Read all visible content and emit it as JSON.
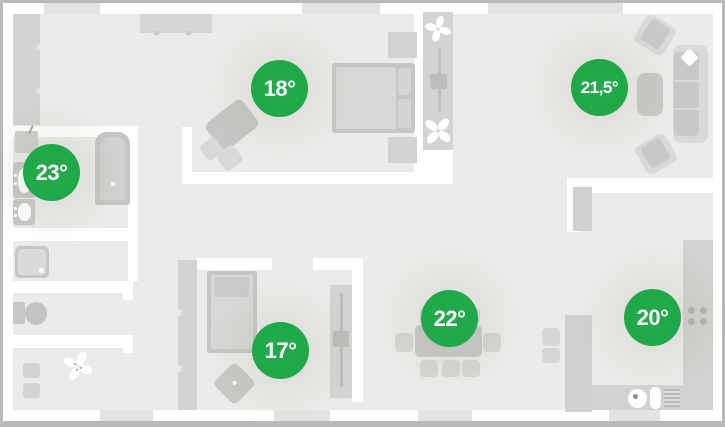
{
  "floorplan": {
    "rooms": [
      {
        "id": "bedroom",
        "temp": "18°"
      },
      {
        "id": "living-room",
        "temp": "21,5°"
      },
      {
        "id": "bathroom",
        "temp": "23°"
      },
      {
        "id": "kids-room",
        "temp": "17°"
      },
      {
        "id": "dining-area",
        "temp": "22°"
      },
      {
        "id": "kitchen",
        "temp": "20°"
      }
    ],
    "colors": {
      "frame": "#b9b9b9",
      "wall": "#ffffff",
      "floor": "#ecebe9",
      "window": "#e4e4e2",
      "furn": "#d3d3d1",
      "furn-dark": "#c6c6c4",
      "furn-light": "#d9d9d7",
      "badge": "#0fae41",
      "badge-text": "#ffffff"
    }
  }
}
